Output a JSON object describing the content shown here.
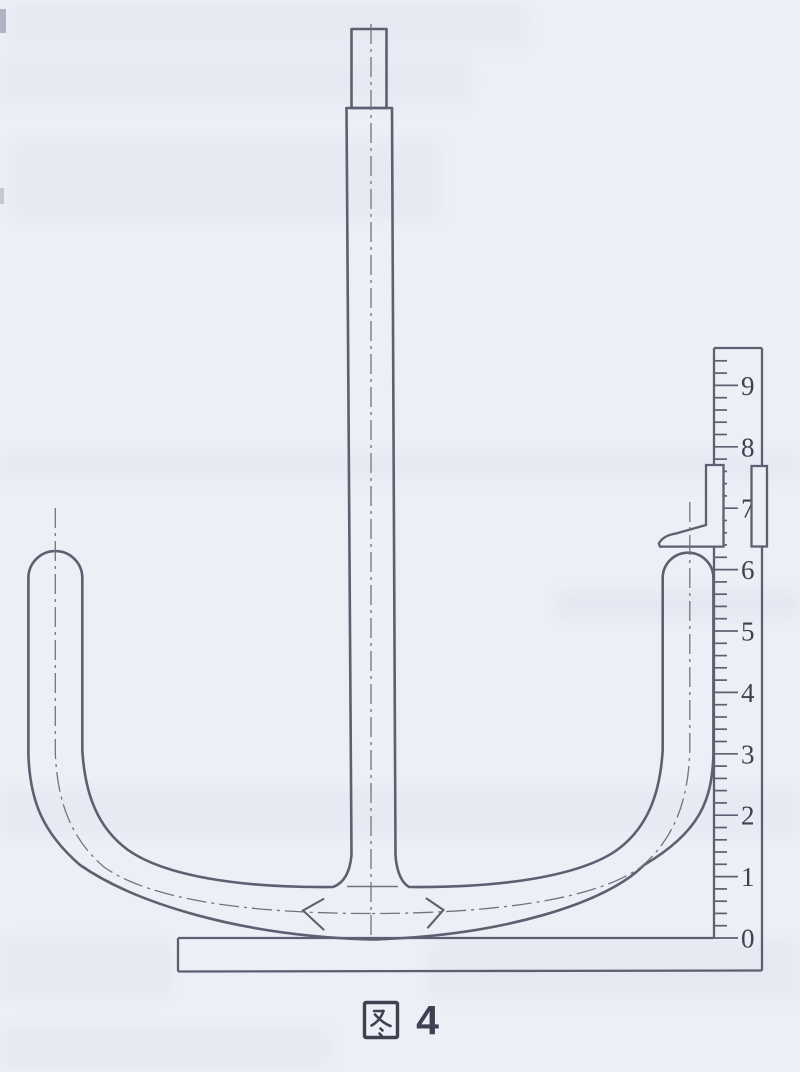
{
  "figure": {
    "caption": "图 4",
    "caption_character": "图",
    "caption_number": "4"
  },
  "ruler": {
    "unit_labels": [
      "0",
      "1",
      "2",
      "3",
      "4",
      "5",
      "6",
      "7",
      "8",
      "9"
    ],
    "min": 0,
    "max": 9.4,
    "minor_step": 0.2,
    "pointer_reading_approx": 6.4
  },
  "colors": {
    "paper": "#edeff7",
    "ink": "#5c6070",
    "ink2": "#70747f",
    "text": "#3e4250",
    "smudge": "#8890b0"
  }
}
